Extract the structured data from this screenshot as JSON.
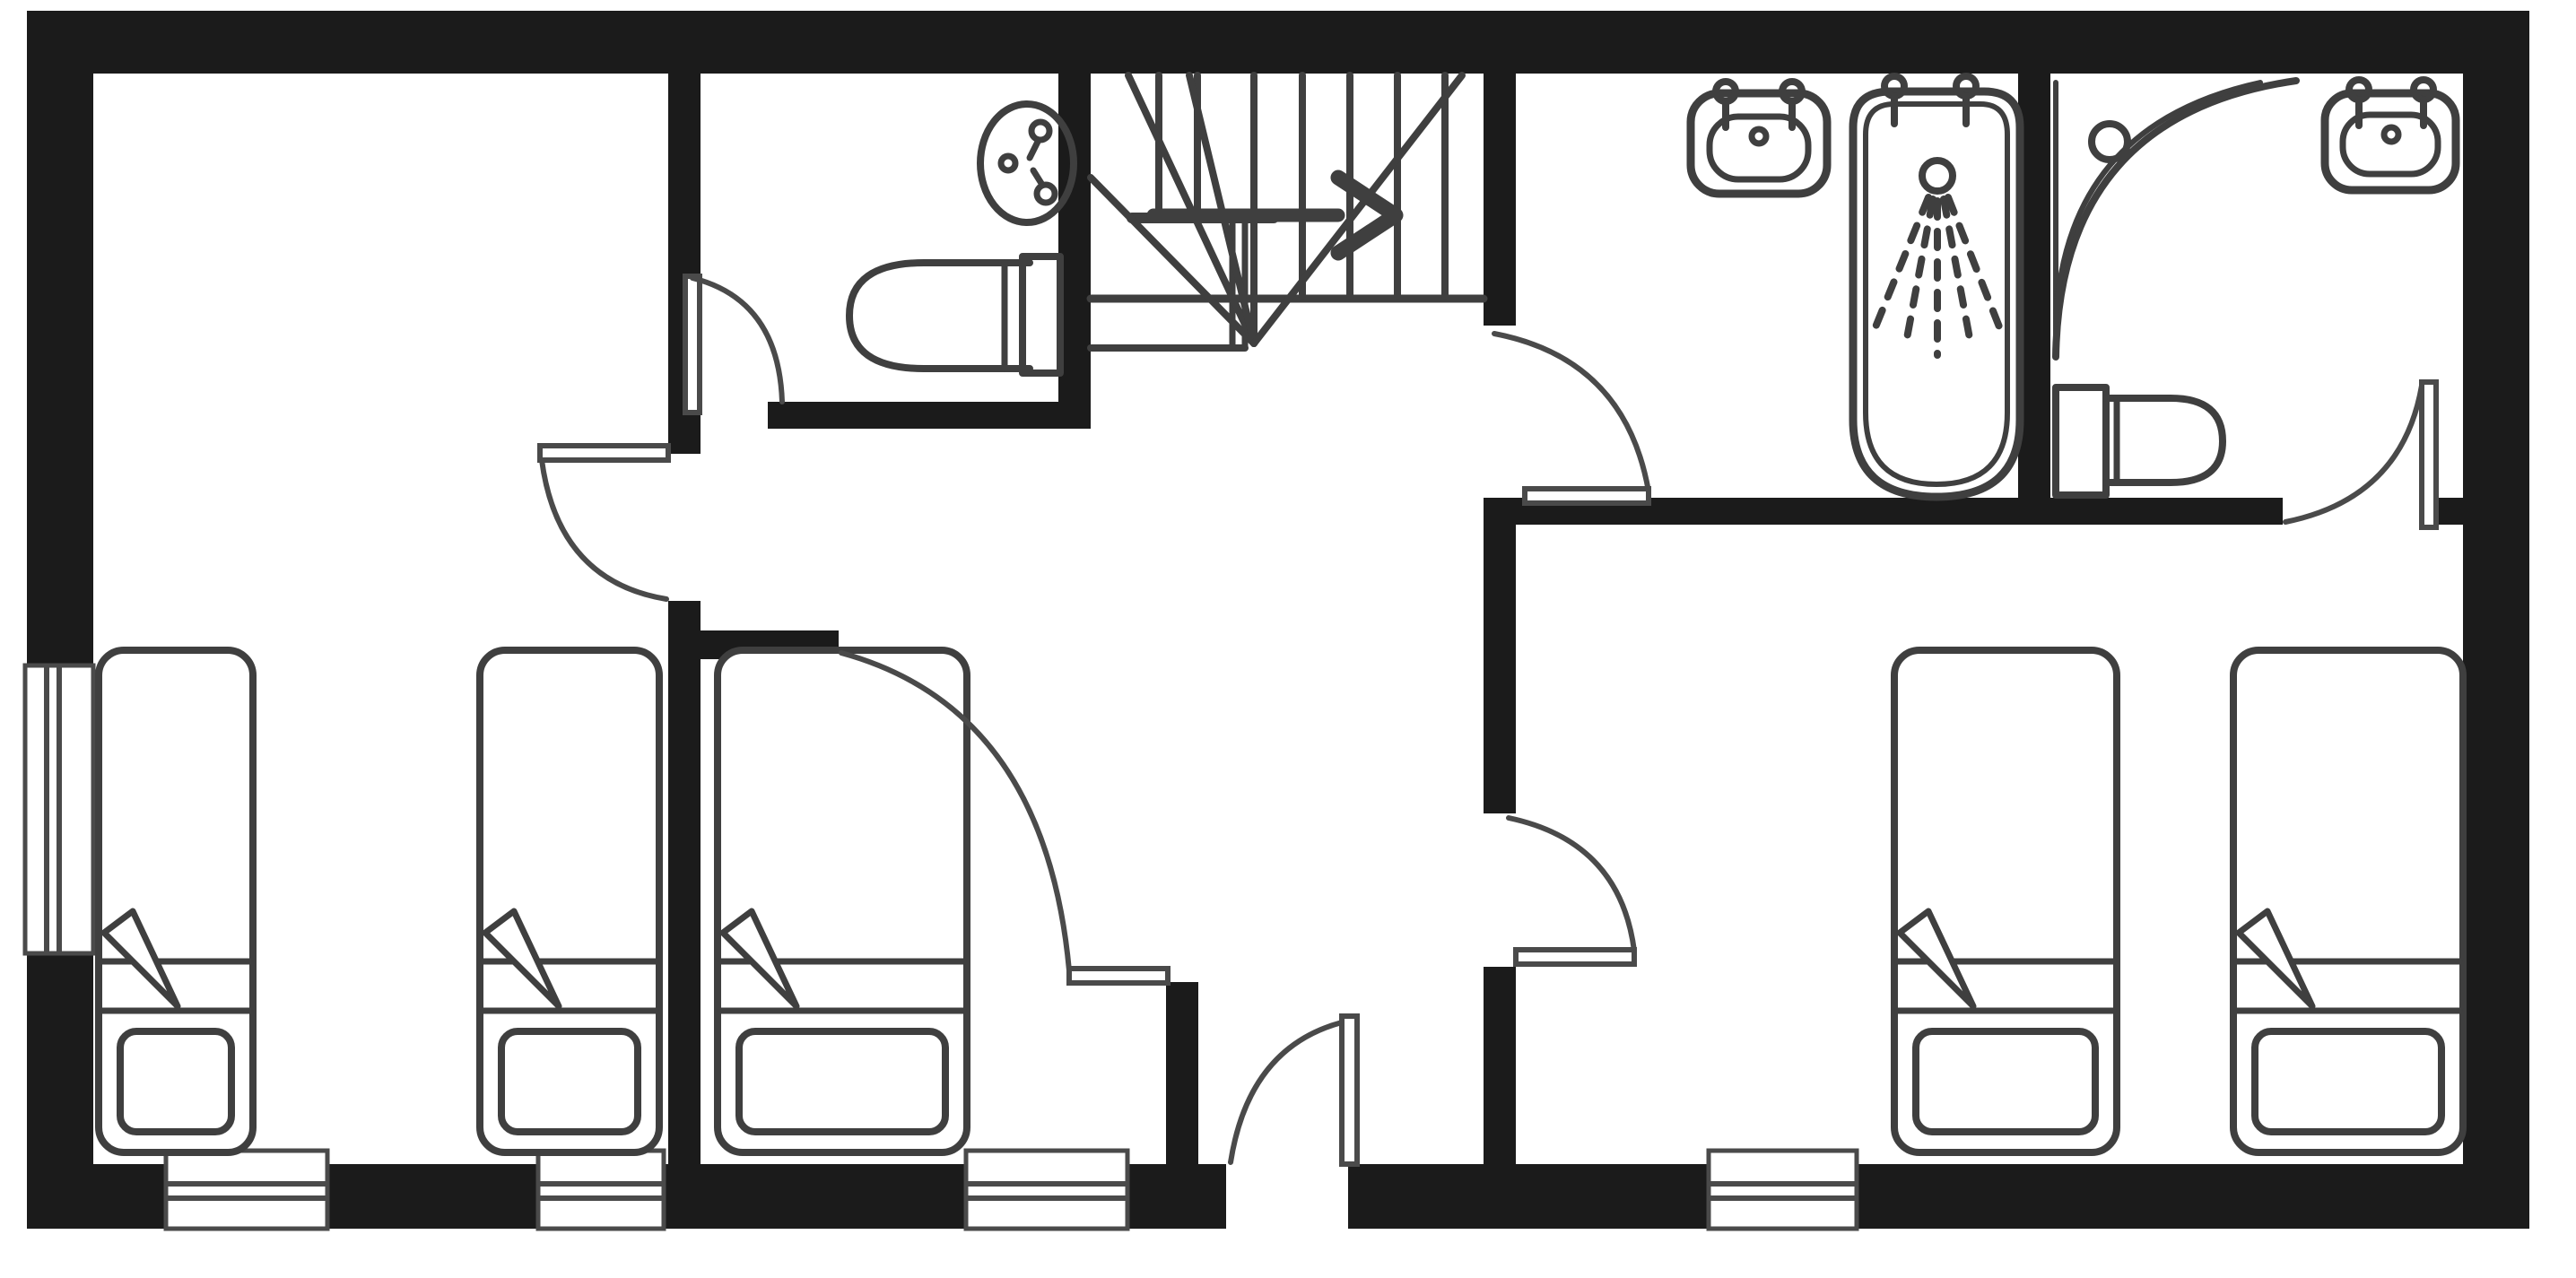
{
  "plan": {
    "title": "Hand-drawn floor plan, black marker on white paper",
    "colors": {
      "walls": "#1b1b1b",
      "ink": "#3f3f3f",
      "paper": "#ffffff"
    },
    "totals": {
      "bedrooms": 3,
      "beds": 5,
      "wash_basins": 3,
      "toilets": 2,
      "bathtubs": 1,
      "corner_showers": 1,
      "doors": 7,
      "windows": 5
    }
  },
  "rooms": {
    "bedroom1": {
      "label": "Bedroom 1 - twin room with 2 single beds, window in left wall and bottom wall"
    },
    "bedroom2": {
      "label": "Bedroom 2 - single room with 1 bed and bottom window"
    },
    "bedroom3": {
      "label": "Bedroom 3 - twin room with 2 single beds and bottom window"
    },
    "wc": {
      "label": "WC - round wash basin and toilet"
    },
    "bathroom": {
      "label": "Bathroom - wash basin and bathtub with shower spray"
    },
    "shower_room": {
      "label": "Shower room - corner shower with drain, wash basin and toilet"
    },
    "hall": {
      "label": "Landing / hallway with winder staircase"
    }
  },
  "stairs": {
    "type": "winder staircase",
    "arrow_direction": "right",
    "straight_treads": 6,
    "winder_treads": 5
  },
  "fixtures": {
    "bed": {
      "label": "Single bed with sheet lines, folded-back corner and pillow at the foot"
    },
    "basin": {
      "label": "Wash basin with two taps and drain"
    },
    "toilet": {
      "label": "Toilet with cistern against wall"
    },
    "bathtub": {
      "label": "Bathtub with two taps and shower head spraying"
    },
    "corner_shower": {
      "label": "Quarter-circle corner shower tray with drain"
    }
  },
  "doors": {
    "wc_door": "WC door, swings into WC",
    "bedroom1_door": "Bedroom 1 door, swings into bedroom",
    "bedroom2_door": "Bedroom 2 door, wide swing from hall",
    "hall_exterior_door": "Door in bottom wall from hall",
    "bathroom_door": "Bathroom door, swings against south wall",
    "bedroom3_door": "Bedroom 3 door, swings into bedroom",
    "shower_room_door": "Shower room door, swings up against east jamb"
  },
  "windows": {
    "left_wall_window": "Window in left exterior wall",
    "bottom_window_1": "Bottom wall window under bedroom 1",
    "bottom_window_2": "Bottom wall window under bedroom 1 (second)",
    "bottom_window_3": "Bottom wall window under bedroom 2",
    "bottom_window_4": "Bottom wall window under bedroom 3"
  }
}
